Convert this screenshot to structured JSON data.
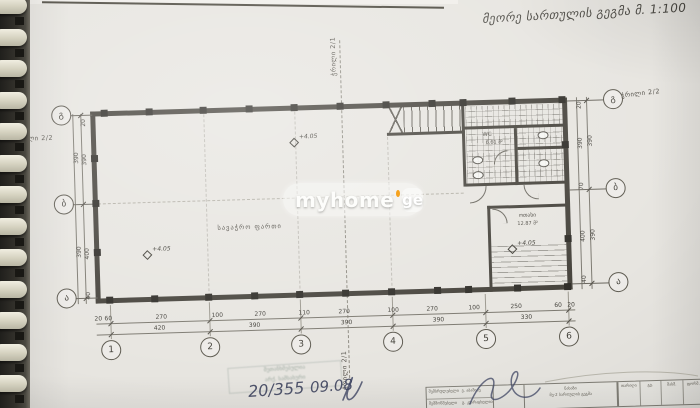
{
  "page": {
    "title_note": "მეორე სართულის გეგმა მ. 1:100"
  },
  "watermark": {
    "brand": "myhome",
    "tld": "ge",
    "dot_color": "#f6a21d"
  },
  "section_labels": {
    "top": "ჭრილი 2/1",
    "bottom": "ჭრილი 2/1",
    "left": "ჭრილი 2/2",
    "right": "ჭრილი 2/2"
  },
  "rooms": {
    "hall": "სავაჭრო ფართი",
    "wc": "WC",
    "wc_area": "6.61 მ²",
    "room": "ოთახი",
    "room_area": "12.87 მ²"
  },
  "elevation_label": "+4.05",
  "elevations": [
    {
      "x": 296,
      "y": 141
    },
    {
      "x": 146,
      "y": 249
    },
    {
      "x": 511,
      "y": 254
    }
  ],
  "grid": {
    "cols": [
      {
        "x": 107,
        "t": "1"
      },
      {
        "x": 206,
        "t": "2"
      },
      {
        "x": 297,
        "t": "3"
      },
      {
        "x": 389,
        "t": "4"
      },
      {
        "x": 482,
        "t": "5"
      },
      {
        "x": 565,
        "t": "6"
      }
    ],
    "rows": [
      {
        "y": 107,
        "t": "გ"
      },
      {
        "y": 196,
        "t": "ბ"
      },
      {
        "y": 290,
        "t": "ა"
      }
    ]
  },
  "dims": {
    "bottom_detail": [
      {
        "x": 95,
        "t": "20"
      },
      {
        "x": 105,
        "t": "60"
      },
      {
        "x": 158,
        "t": "270"
      },
      {
        "x": 214,
        "t": "100"
      },
      {
        "x": 257,
        "t": "270"
      },
      {
        "x": 301,
        "t": "110"
      },
      {
        "x": 341,
        "t": "270"
      },
      {
        "x": 390,
        "t": "100"
      },
      {
        "x": 429,
        "t": "270"
      },
      {
        "x": 471,
        "t": "100"
      },
      {
        "x": 513,
        "t": "250"
      },
      {
        "x": 555,
        "t": "60"
      },
      {
        "x": 568,
        "t": "20"
      }
    ],
    "bottom_total": [
      {
        "x": 156,
        "t": "420"
      },
      {
        "x": 251,
        "t": "390"
      },
      {
        "x": 343,
        "t": "390"
      },
      {
        "x": 435,
        "t": "390"
      },
      {
        "x": 523,
        "t": "330"
      }
    ],
    "left_inner": [
      {
        "y": 115,
        "t": "20"
      },
      {
        "y": 152,
        "t": "390"
      },
      {
        "y": 246,
        "t": "400"
      },
      {
        "y": 288,
        "t": "40"
      }
    ],
    "left_outer": [
      {
        "y": 150,
        "t": "390"
      },
      {
        "y": 244,
        "t": "390"
      }
    ],
    "right_inner": [
      {
        "y": 112,
        "t": "20"
      },
      {
        "y": 150,
        "t": "390"
      },
      {
        "y": 193,
        "t": "70"
      },
      {
        "y": 243,
        "t": "400"
      },
      {
        "y": 286,
        "t": "40"
      }
    ],
    "right_outer": [
      {
        "y": 148,
        "t": "390"
      },
      {
        "y": 242,
        "t": "390"
      }
    ]
  },
  "annotations": {
    "handwriting_a": "20/355",
    "handwriting_b": "09.08",
    "stamp_line1": "შეთანხმებულია",
    "stamp_line2": "არქ. სამსახური"
  },
  "title_block": {
    "r1c1": "შემსრულებელი",
    "r1c2": "ვ. აბაშიძე",
    "r2c1": "შემმოწმებელი",
    "r2c2": "გ. კვარაცხელია",
    "mid1": "ნახაზი",
    "mid2": "მე-2 სართულის გეგმა",
    "cols": [
      "თარიღი",
      "გვ.",
      "მასშ.",
      "ფორმ."
    ]
  }
}
